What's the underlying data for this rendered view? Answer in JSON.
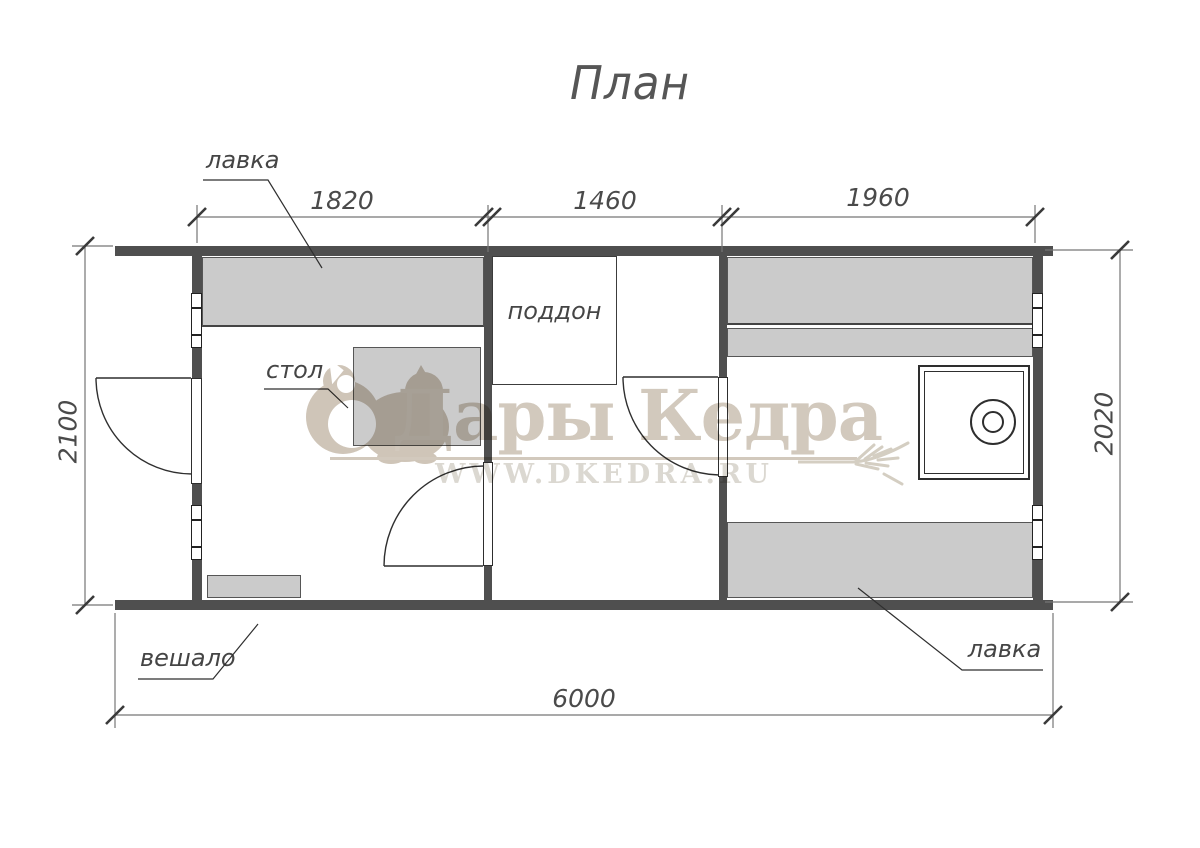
{
  "title": "План",
  "callouts": {
    "bench_top": "лавка",
    "table": "стол",
    "tray": "поддон",
    "hanger": "вешало",
    "bench_bottom": "лавка"
  },
  "dimensions": {
    "top_segments": [
      "1820",
      "1460",
      "1960"
    ],
    "left": "2100",
    "right": "2020",
    "bottom": "6000"
  },
  "watermark": {
    "brand": "Дары Кедра",
    "url": "WWW.DKEDRA.RU",
    "logo_icon": "squirrel-silhouette",
    "flourish_icon": "wheat-ear"
  },
  "colors": {
    "wall": "#4f4f4f",
    "furniture_fill": "#cbcbcb",
    "line": "#2f2f2f",
    "dim_line": "#707070",
    "text": "#454545",
    "watermark_brand": "#d2c9bd",
    "watermark_url": "#dbd8d1"
  }
}
